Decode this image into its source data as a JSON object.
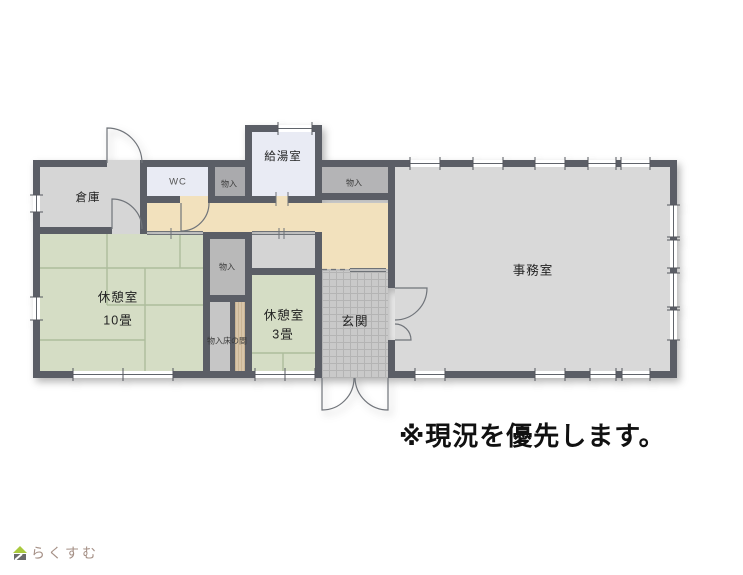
{
  "plan": {
    "rooms": {
      "souko": {
        "label": "倉庫"
      },
      "wc": {
        "label": "WC"
      },
      "monoire_top1": {
        "label": "物入"
      },
      "kyutoshitsu": {
        "label": "給湯室"
      },
      "monoire_top2": {
        "label": "物入"
      },
      "kyukeishitsu_10": {
        "label": "休憩室",
        "size": "10畳"
      },
      "monoire_mid": {
        "label": "物入"
      },
      "monoire_tokonoma": {
        "label": "物入床の間"
      },
      "kyukeishitsu_3": {
        "label": "休憩室",
        "size": "3畳"
      },
      "genkan": {
        "label": "玄関"
      },
      "jimushitsu": {
        "label": "事務室"
      }
    },
    "note": "※現況を優先します。",
    "colors": {
      "wall": "#5b5e66",
      "corridor": "#f2e1bd",
      "tatami_green": "#d5ddc5",
      "storage_gray": "#aaaaad",
      "room_gray": "#d6d6d6",
      "office_gray": "#d9d9d9",
      "wc_floor": "#e9ebf4",
      "entry_tile": "#c9c9c9",
      "tokonoma_wood": "#d8c5a9"
    }
  },
  "footer": {
    "logo_text": "らくすむ"
  }
}
